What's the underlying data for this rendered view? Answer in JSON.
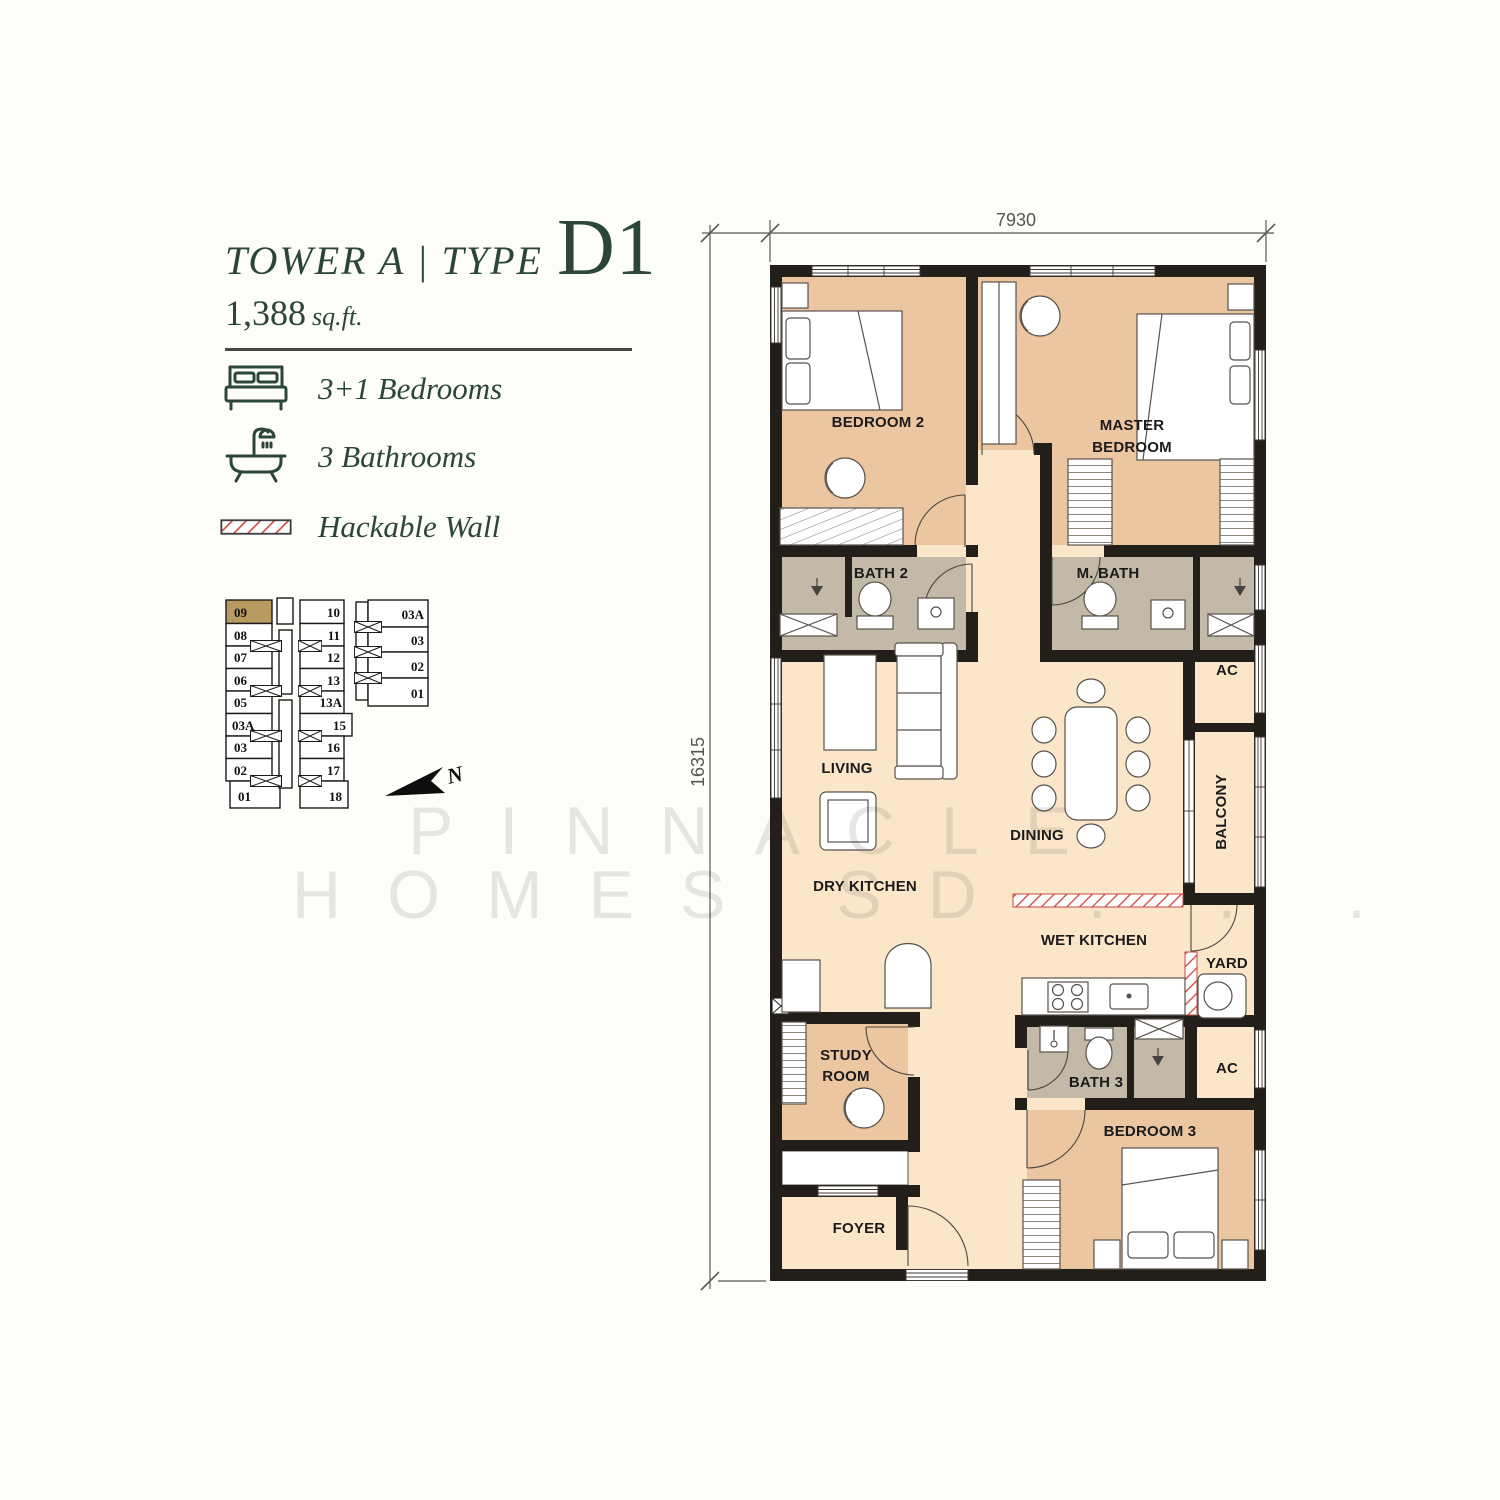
{
  "title": {
    "prefix": "TOWER A | TYPE",
    "type_code": "D1"
  },
  "area": {
    "value": "1,388",
    "unit": "sq.ft."
  },
  "legend": {
    "bedrooms": "3+1 Bedrooms",
    "bathrooms": "3 Bathrooms",
    "hackable": "Hackable Wall"
  },
  "key_plan": {
    "highlighted_unit": "09",
    "tower_a_left": [
      "09",
      "08",
      "07",
      "06",
      "05",
      "03A",
      "03",
      "02",
      "01"
    ],
    "tower_a_right": [
      "10",
      "11",
      "12",
      "13",
      "13A",
      "15",
      "16",
      "17",
      "18"
    ],
    "tower_b": [
      "03A",
      "03",
      "02",
      "01"
    ],
    "north_label": "N"
  },
  "dimensions": {
    "width": "7930",
    "height": "16315"
  },
  "rooms": {
    "bedroom2": "BEDROOM 2",
    "master_line1": "MASTER",
    "master_line2": "BEDROOM",
    "bath2": "BATH 2",
    "mbath": "M. BATH",
    "living": "LIVING",
    "dining": "DINING",
    "ac_top": "AC",
    "balcony": "BALCONY",
    "dry_kitchen": "DRY KITCHEN",
    "wet_kitchen": "WET KITCHEN",
    "yard": "YARD",
    "study_line1": "STUDY",
    "study_line2": "ROOM",
    "bath3": "BATH 3",
    "ac_bottom": "AC",
    "bedroom3": "BEDROOM 3",
    "foyer": "FOYER"
  },
  "watermark": {
    "line1": "PINNACLE",
    "line2": "HOMES SD . . ."
  },
  "colors": {
    "accent_green": "#2b4638",
    "room_tan": "#ecc5a1",
    "room_cream": "#fbe6ca",
    "bath_grey": "#c3b9a8",
    "wall": "#221e1a",
    "highlight_unit": "#b99b62",
    "hackable_red": "#d0453c"
  }
}
